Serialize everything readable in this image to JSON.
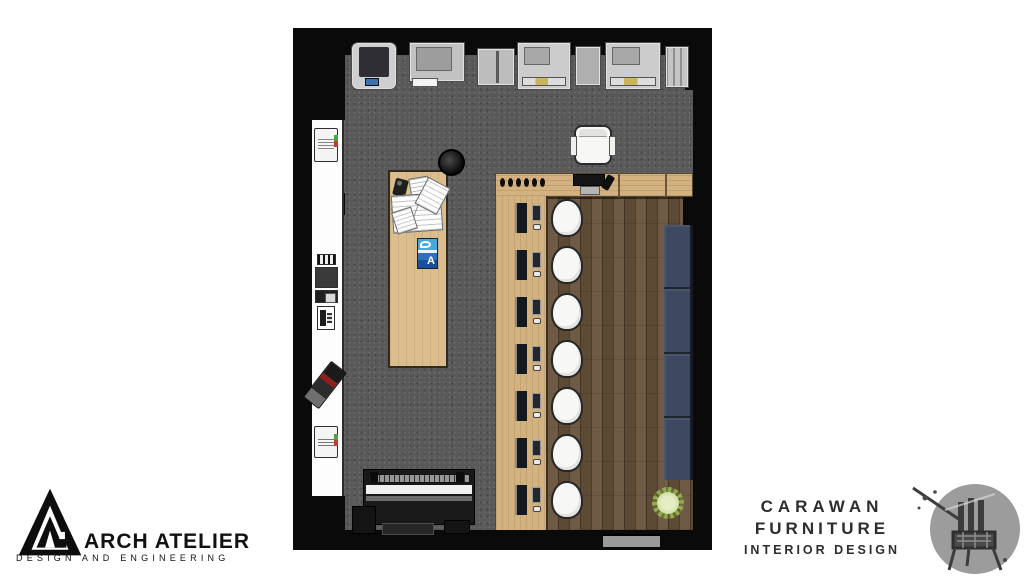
{
  "colors": {
    "wall": "#0a0a0a",
    "carpet": "#595959",
    "wood-light": "#d3b27f",
    "wood-table": "#dcbe8e",
    "wood-dark": "#5d4a35",
    "sofa": "#3d4960",
    "stool": "#f7f7f5",
    "machine": "#c9c9c9",
    "plant": "#8fae4a",
    "magazine-blue": "#1b4e9b",
    "door": "#9a9a9a",
    "logo-ink": "#111111",
    "carawan-ink": "#2d2d2d",
    "logo-gray": "#9c9c9c"
  },
  "branding": {
    "arch_atelier": {
      "name": "ARCH ATELIER",
      "tagline": "DESIGN AND ENGINEERING"
    },
    "carawan": {
      "line1": "CARAWAN",
      "line2": "FURNITURE",
      "line3": "INTERIOR DESIGN"
    }
  },
  "plan": {
    "workstations": 7,
    "sofa_cushions": 4,
    "counter_dots": 6,
    "top_machines": 7,
    "magazine_letter": "A"
  }
}
